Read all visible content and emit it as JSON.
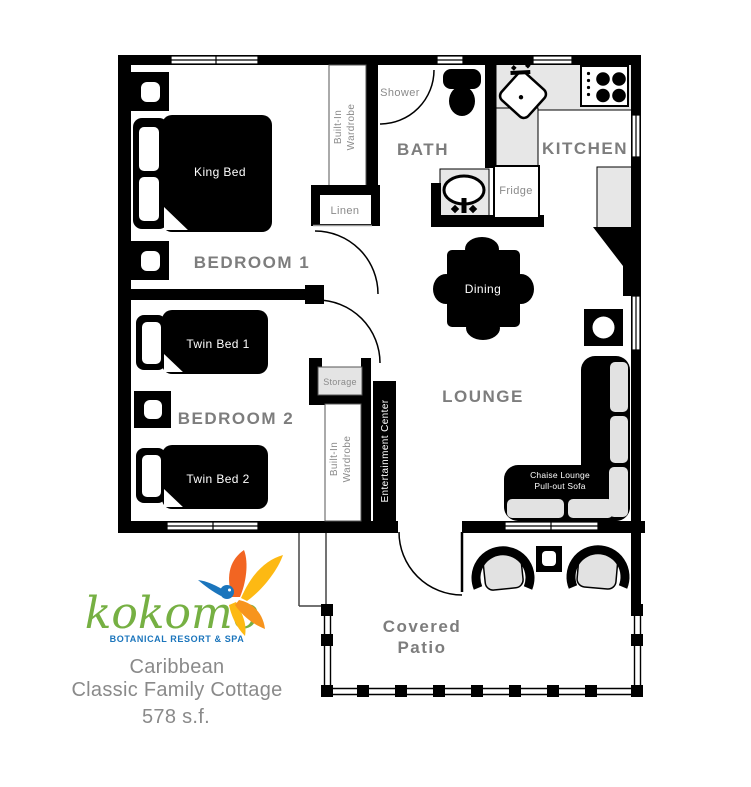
{
  "floorplan": {
    "rooms": {
      "bedroom1": "BEDROOM 1",
      "bedroom2": "BEDROOM 2",
      "bath": "BATH",
      "kitchen": "KITCHEN",
      "lounge": "LOUNGE",
      "patio_line1": "Covered",
      "patio_line2": "Patio"
    },
    "furniture": {
      "king_bed": "King Bed",
      "twin_bed1": "Twin Bed 1",
      "twin_bed2": "Twin Bed 2",
      "dining": "Dining",
      "shower": "Shower",
      "fridge": "Fridge",
      "linen": "Linen",
      "storage": "Storage",
      "wardrobe_line1": "Built-In",
      "wardrobe_line2": "Wardrobe",
      "entertainment_center": "Entertainment Center",
      "sofa_line1": "Chaise Lounge",
      "sofa_line2": "Pull-out Sofa"
    }
  },
  "branding": {
    "logo_text": "kokomo",
    "logo_tagline": "BOTANICAL RESORT & SPA",
    "title_line1": "Caribbean",
    "title_line2": "Classic Family Cottage",
    "area": "578 s.f."
  },
  "colors": {
    "wall_black": "#000000",
    "label_gray": "#7d7d7d",
    "counter_gray": "#e7e7e7",
    "cushion_gray": "#e2e2e2",
    "logo_green": "#76b043",
    "logo_blue": "#1b75bc",
    "logo_orange": "#f26522",
    "logo_yellow": "#fdb913"
  }
}
